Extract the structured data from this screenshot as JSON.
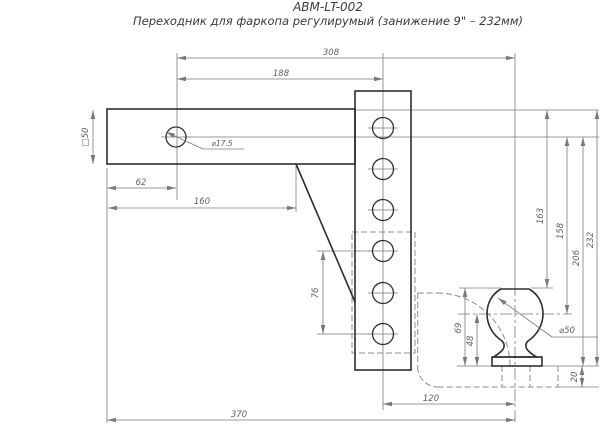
{
  "header": {
    "title": "ABM-LT-002",
    "subtitle": "Переходник для фаркопа регулирумый (занижение 9\" – 232мм)"
  },
  "colors": {
    "outline": "#2e2e2e",
    "dimline": "#7a7a7a",
    "dimtext": "#5f5f5f",
    "hidden": "#8c8c8c",
    "background": "#ffffff"
  },
  "dimensions": {
    "hole_to_ball_center_horiz": "308",
    "hole_to_column_center": "188",
    "shank_square_section": "□50",
    "shank_hole_dia": "⌀17.5",
    "shank_edge_to_hole": "62",
    "shank_length": "160",
    "hole_pitch_double": "76",
    "overall_length": "370",
    "column_to_ball_center": "120",
    "top_to_ball_top": "163",
    "hole_axis_to_ball_center": "158",
    "hole_axis_to_platform": "206",
    "max_drop": "232",
    "ball_assembly_height": "69",
    "ball_center_height": "48",
    "ball_dia": "⌀50",
    "arm_plate_thickness": "20"
  }
}
